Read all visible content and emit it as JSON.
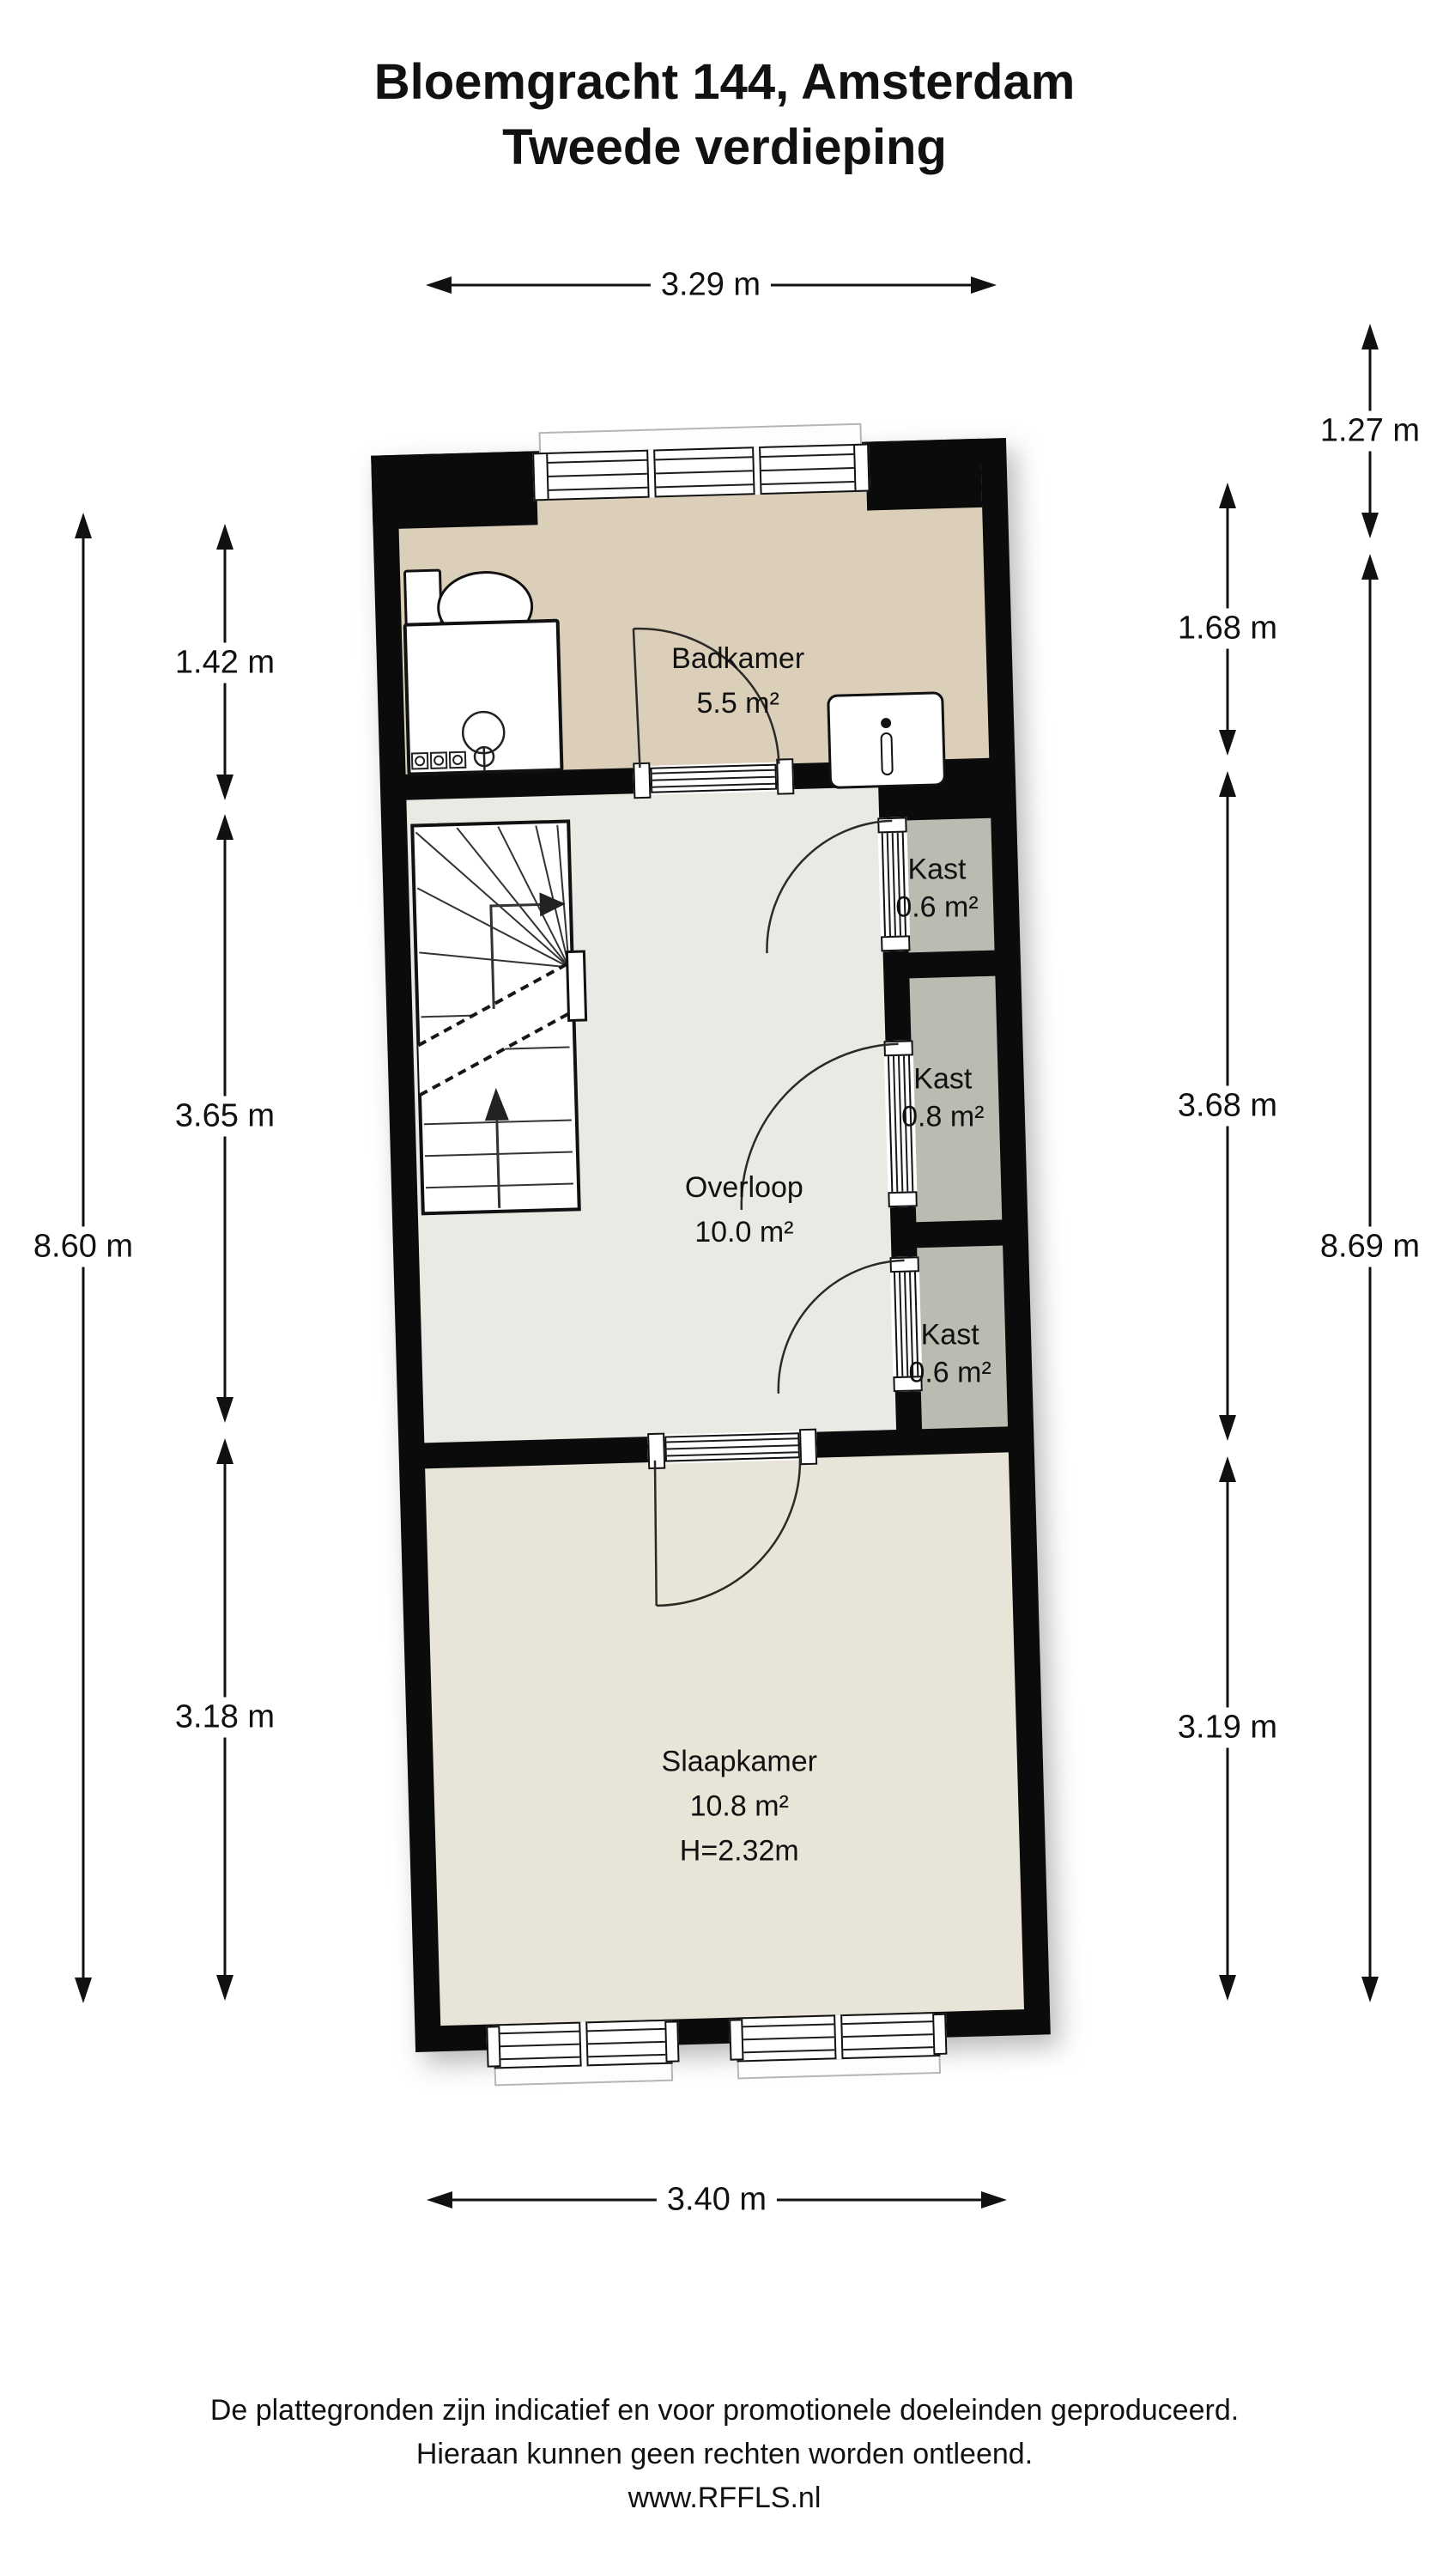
{
  "title": {
    "line1": "Bloemgracht 144, Amsterdam",
    "line2": "Tweede verdieping"
  },
  "dimensions": {
    "top": "3.29 m",
    "bottom": "3.40 m",
    "left_outer": "8.60 m",
    "left_inner": [
      "1.42 m",
      "3.65 m",
      "3.18 m"
    ],
    "right_inner": [
      "1.68 m",
      "3.68 m",
      "3.19 m"
    ],
    "right_outer": [
      "1.27 m",
      "8.69 m"
    ]
  },
  "rooms": {
    "badkamer": {
      "name": "Badkamer",
      "area": "5.5 m²"
    },
    "overloop": {
      "name": "Overloop",
      "area": "10.0 m²"
    },
    "kast_top": {
      "name": "Kast",
      "area": "0.6 m²"
    },
    "kast_middle": {
      "name": "Kast",
      "area": "0.8 m²"
    },
    "kast_bottom": {
      "name": "Kast",
      "area": "0.6 m²"
    },
    "slaapkamer": {
      "name": "Slaapkamer",
      "area": "10.8 m²",
      "height": "H=2.32m"
    }
  },
  "footer": {
    "line1": "De plattegronden zijn indicatief en voor promotionele doeleinden geproduceerd.",
    "line2": "Hieraan kunnen geen rechten worden ontleend.",
    "line3": "www.RFFLS.nl"
  },
  "colors": {
    "wall": "#0b0b0b",
    "badkamer_floor": "#dccfba",
    "overloop_floor": "#ebe9e3",
    "slaapkamer_floor": "#e8e4d8",
    "kast_floor": "#b8bcb1",
    "line": "#1c1c1c",
    "background": "#ffffff"
  }
}
